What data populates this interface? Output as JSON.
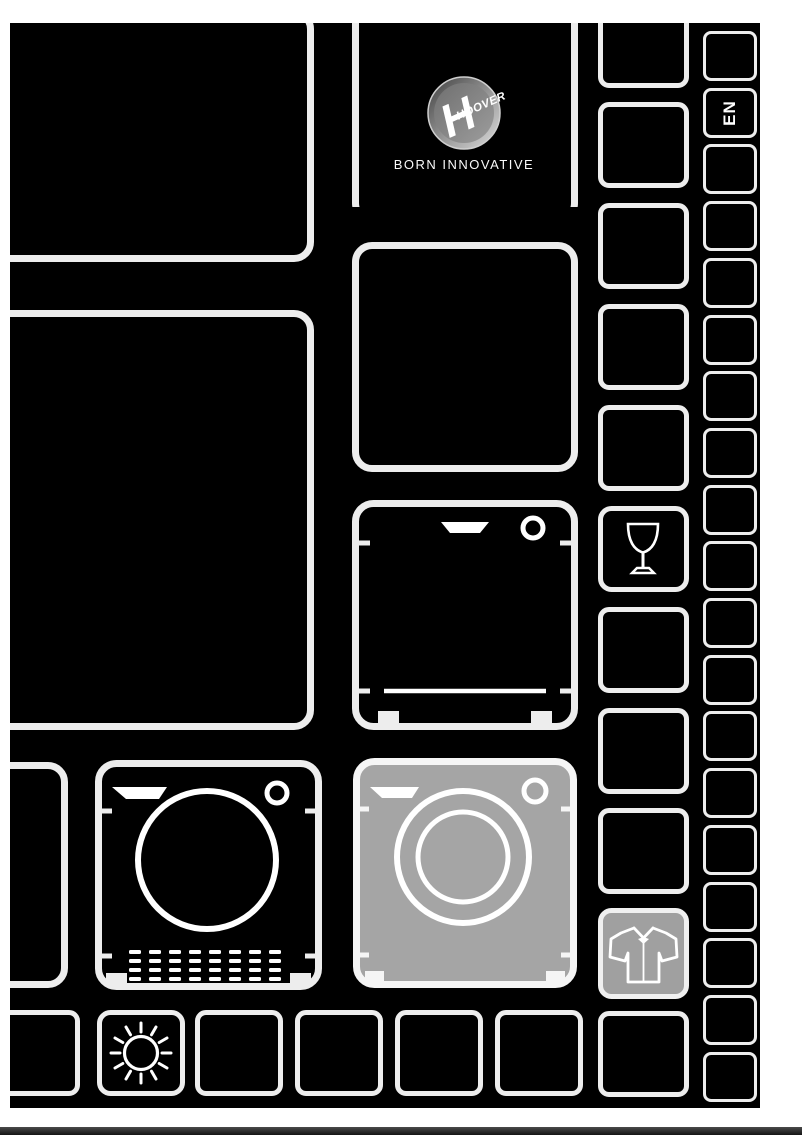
{
  "brand": {
    "name": "HOOVER",
    "tagline": "BORN INNOVATIVE"
  },
  "language_tab": {
    "label": "EN"
  },
  "icon_tiles": [
    {
      "icon": "wine-glass-icon",
      "highlighted": false
    },
    {
      "icon": "shirt-icon",
      "highlighted": true
    },
    {
      "icon": "tumble-dryer-icon",
      "highlighted": false
    },
    {
      "icon": "washing-machine-icon",
      "highlighted": true
    },
    {
      "icon": "dishwasher-icon",
      "highlighted": false
    },
    {
      "icon": "sun-icon",
      "highlighted": false
    }
  ],
  "colors": {
    "page_bg": "#000000",
    "margin_bg": "#ffffff",
    "tile_border": "#ededed",
    "highlight_fill": "#a5a5a5",
    "icon_stroke": "#ffffff",
    "bottom_strip": "#2e2e2e"
  }
}
